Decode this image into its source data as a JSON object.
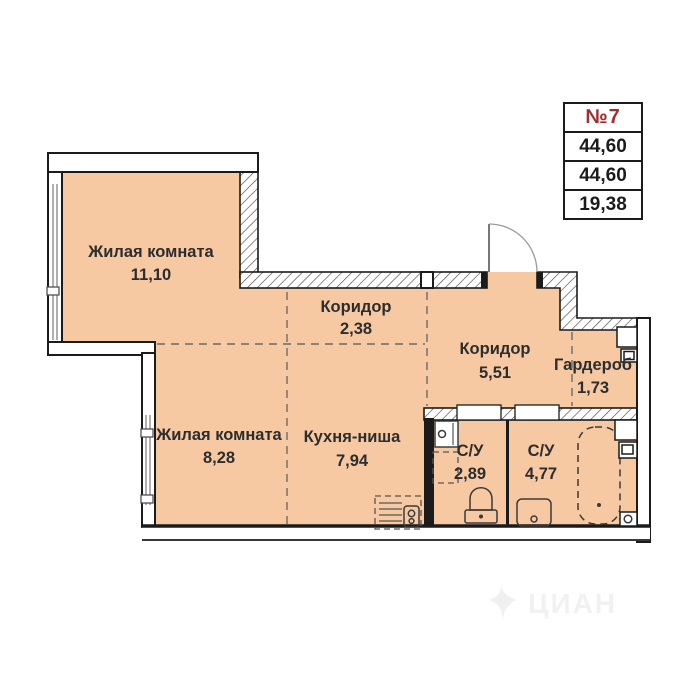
{
  "unit_info": {
    "number": "№7",
    "total_area": "44,60",
    "area": "44,60",
    "living_area": "19,38"
  },
  "rooms": [
    {
      "name": "Жилая комната",
      "area": "11,10"
    },
    {
      "name": "Коридор",
      "area": "2,38"
    },
    {
      "name": "Коридор",
      "area": "5,51"
    },
    {
      "name": "Гардероб",
      "area": "1,73"
    },
    {
      "name": "Жилая комната",
      "area": "8,28"
    },
    {
      "name": "Кухня-ниша",
      "area": "7,94"
    },
    {
      "name": "С/У",
      "area": "2,89"
    },
    {
      "name": "С/У",
      "area": "4,77"
    }
  ],
  "icons": {
    "fixtures": [
      "entrance-door-icon",
      "bathtub-icon",
      "toilet-icon",
      "washing-machine-icon",
      "sink-icon",
      "kitchen-unit-icon",
      "ventilation-shaft-icon",
      "drain-icon"
    ]
  },
  "watermark": {
    "text": "ЦИАН"
  },
  "colors": {
    "floor": "#f6c9a3",
    "wall": "#1b1b1b",
    "hatch": "#4a4a4a",
    "accent_red": "#a32d2d",
    "zone_divider": "#6b6b6b",
    "window_glass": "#8f8f8f",
    "watermark": "#f1f1f1"
  }
}
